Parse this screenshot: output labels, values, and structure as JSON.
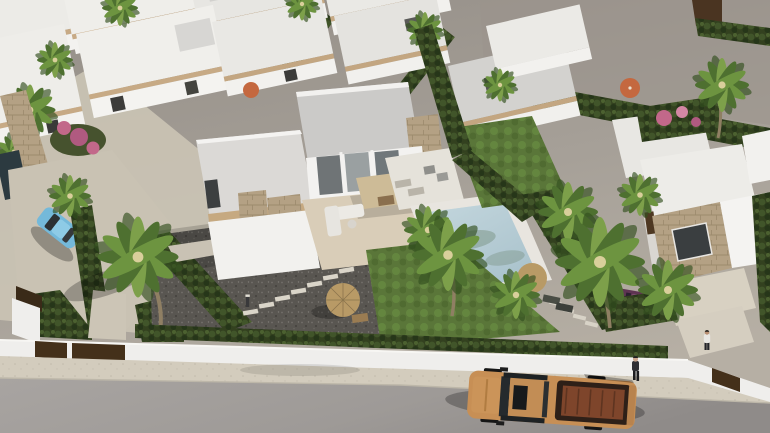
{
  "scene": {
    "type": "3d-architectural-render",
    "view": "aerial-oblique",
    "description": "Aerial render of a modern residential development: rows of white flat-roof villas with travertine stone accents, private pools, lawns, palm trees and cypress hedges; a street with sidewalk, boundary walls and gates runs along the bottom; an unbuilt grey plot fills the upper right."
  },
  "palette": {
    "ground": "#a29c94",
    "ground_dark": "#968f88",
    "road": "#a09c99",
    "sidewalk": "#d3ccbd",
    "wall_white": "#efeeec",
    "villa_white": "#f2f1ee",
    "villa_shadow": "#d8d5d0",
    "roof_gray": "#cbcac8",
    "roof_light": "#e9e8e4",
    "stone": "#b4a184",
    "hedge": "#33411f",
    "lawn": "#5a7639",
    "palm_green": "#4e7030",
    "trunk": "#8f7f63",
    "pool_water": "#bcd2da",
    "pool_deep": "#9fb9c4",
    "gravel": "#595651",
    "concrete": "#c9c2b3",
    "parasol_straw": "#b89a66",
    "parasol_orange": "#c4683f",
    "gate_brown": "#44301a",
    "truck_body": "#c78f55",
    "truck_bed_floor": "#7e452b",
    "car_blue": "#74b9da",
    "car_maroon": "#5e3452",
    "glass_dark": "#3f4244",
    "flowers_pink": "#c2688a"
  },
  "inventory": {
    "villas_visible": 12,
    "pools_visible": 2,
    "palm_trees_visible": 16,
    "straw_parasols": 2,
    "orange_parasols": 2,
    "vehicles": [
      {
        "type": "pickup-truck",
        "color": "tan",
        "location": "street"
      },
      {
        "type": "compact-car",
        "color": "light-blue",
        "location": "left driveway"
      },
      {
        "type": "car",
        "color": "maroon",
        "location": "right driveway behind hedge"
      }
    ],
    "people": [
      {
        "location": "sidewalk near truck",
        "clothing": "dark"
      },
      {
        "location": "right property gate",
        "clothing": "white shirt"
      }
    ],
    "garden_features": [
      "outdoor-sofa",
      "pergola",
      "dining-set",
      "sun-loungers",
      "stepping-stones",
      "bollard-light",
      "bougainvillea",
      "cypress-hedges",
      "gravel-yard"
    ]
  }
}
